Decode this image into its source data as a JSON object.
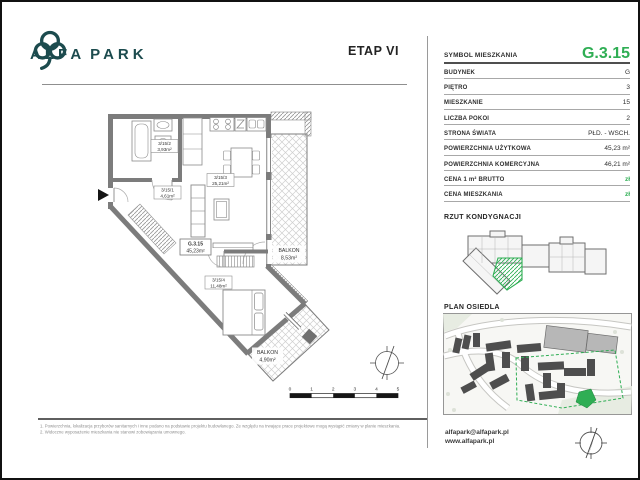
{
  "header": {
    "etap": "ETAP VI",
    "logo_alfa": "ALFA",
    "logo_park": "PARK"
  },
  "panel": {
    "symbol_label": "SYMBOL MIESZKANIA",
    "symbol_value": "G.3.15",
    "rows": [
      {
        "label": "BUDYNEK",
        "value": "G"
      },
      {
        "label": "PIĘTRO",
        "value": "3"
      },
      {
        "label": "MIESZKANIE",
        "value": "15"
      },
      {
        "label": "LICZBA POKOI",
        "value": "2"
      },
      {
        "label": "STRONA ŚWIATA",
        "value": "PŁD. - WSCH."
      },
      {
        "label": "POWIERZCHNIA UŻYTKOWA",
        "value": "45,23 m²"
      },
      {
        "label": "POWIERZCHNIA KOMERCYJNA",
        "value": "46,21 m²"
      },
      {
        "label": "CENA 1 m² BRUTTO",
        "value": "zł"
      },
      {
        "label": "CENA MIESZKANIA",
        "value": "zł"
      }
    ],
    "sections": {
      "rzut": "RZUT KONDYGNACJI",
      "osiedle": "PLAN OSIEDLA"
    },
    "contact": {
      "email": "alfapark@alfapark.pl",
      "www": "www.alfapark.pl"
    }
  },
  "floorplan": {
    "rooms": [
      {
        "code": "3/15/1",
        "area": "4,61m²"
      },
      {
        "code": "3/15/2",
        "area": "3,93m²"
      },
      {
        "code": "3/15/3",
        "area": "25,21m²"
      },
      {
        "code": "3/15/4",
        "area": "11,48m²"
      }
    ],
    "unit": {
      "code": "G.3.15",
      "area": "45,23m²"
    },
    "balkon_right": {
      "label": "BALKON",
      "area": "8,53m²"
    },
    "balkon_bottom": {
      "label": "BALKON",
      "area": "4,90m²"
    },
    "scale": [
      "0",
      "1",
      "2",
      "3",
      "4",
      "5"
    ]
  },
  "footnotes": [
    "1. Powierzchnia, lokalizacja przyborów sanitarnych i inne podano na podstawie projektu budowlanego. Ze względu na trwające prace projektowe mogą wystąpić zmiany w planie mieszkania.",
    "2. Widoczne wyposażenie mieszkania nie stanowi zobowiązania umownego."
  ],
  "colors": {
    "accent_green": "#2FAE54",
    "brand_teal": "#1C4B4E",
    "wall_gray": "#7C7C7C"
  }
}
